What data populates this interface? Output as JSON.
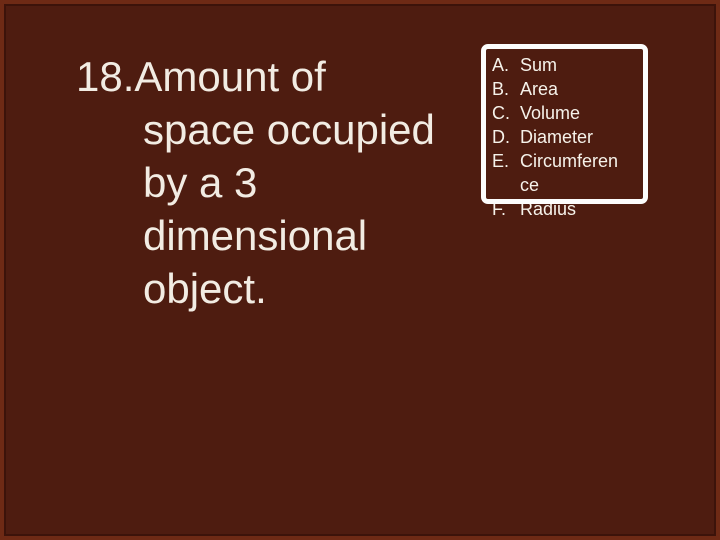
{
  "slide": {
    "question": {
      "lines": [
        "18.Amount of",
        "space occupied",
        "by a 3",
        "dimensional",
        "object."
      ]
    },
    "answers": {
      "items": [
        {
          "prefix": "A.",
          "label": "Sum"
        },
        {
          "prefix": "B.",
          "label": "Area"
        },
        {
          "prefix": "C.",
          "label": "Volume"
        },
        {
          "prefix": "D.",
          "label": "Diameter"
        },
        {
          "prefix": "E.",
          "label": "Circumference"
        },
        {
          "prefix": "F.",
          "label": "Radius"
        }
      ]
    },
    "colors": {
      "background": "#4e1c10",
      "frame": "#6e2a15",
      "frame_line": "#3c130a",
      "text": "#f2ece3",
      "choice_box_border": "#fcfcfc"
    }
  }
}
